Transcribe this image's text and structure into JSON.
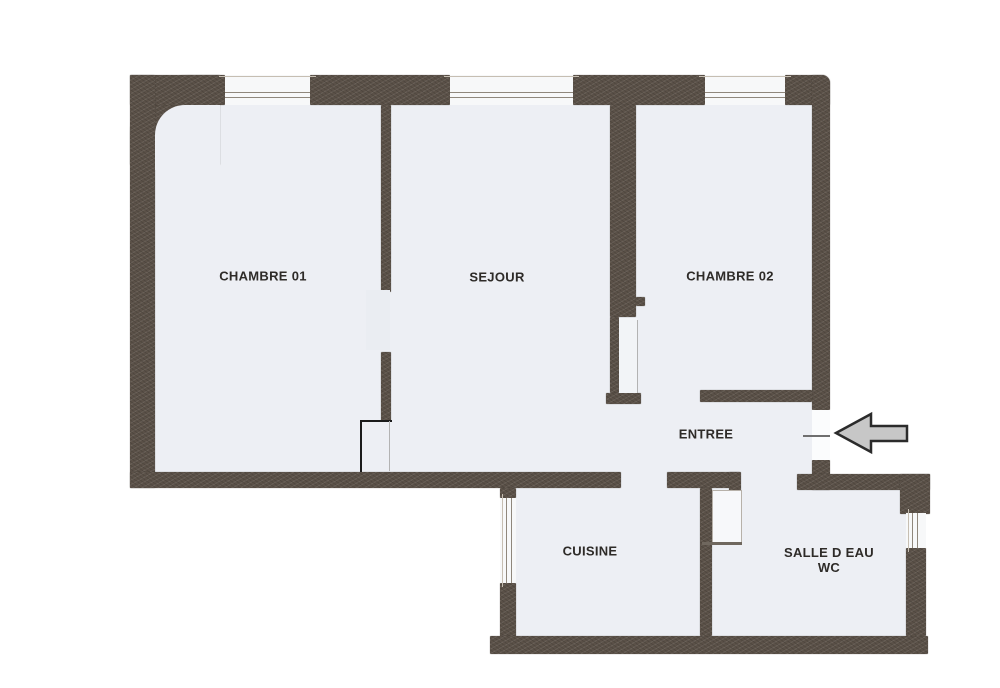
{
  "plan": {
    "type": "apartment-floor-plan",
    "rooms": {
      "chambre01": {
        "label": "CHAMBRE 01"
      },
      "sejour": {
        "label": "SEJOUR"
      },
      "chambre02": {
        "label": "CHAMBRE 02"
      },
      "entree": {
        "label": "ENTREE"
      },
      "cuisine": {
        "label": "CUISINE"
      },
      "salle_d_eau": {
        "label": "SALLE D EAU",
        "label2": "WC"
      }
    },
    "icons": {
      "entrance_arrow": "left-arrow"
    }
  },
  "colors": {
    "paper": "#ffffff",
    "wall": "#5b5148",
    "floor": "#edeff4",
    "label": "#2e2b28",
    "arrow_fill": "#c7c7c7",
    "arrow_stroke": "#2b2b2b",
    "window_line": "#8f877c",
    "door_line": "#1b1b1b"
  }
}
